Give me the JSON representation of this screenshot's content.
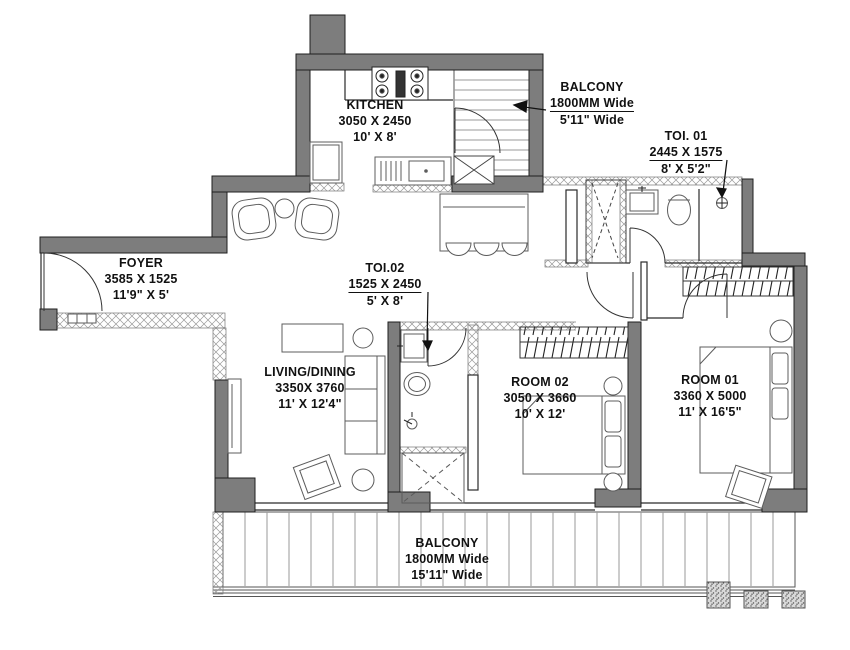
{
  "plan": {
    "title": "2BHK apartment floor plan",
    "colors": {
      "wall": "#7d7d7d",
      "line": "#1f1f1f"
    },
    "rooms": [
      {
        "key": "kitchen",
        "name": "KITCHEN",
        "mm": "3050 X 2450",
        "ft": "10' X 8'"
      },
      {
        "key": "balcony-top",
        "name": "BALCONY",
        "mm": "1800MM Wide",
        "ft": "5'11\" Wide"
      },
      {
        "key": "toi-01",
        "name": "TOI. 01",
        "mm": "2445 X 1575",
        "ft": "8' X 5'2\""
      },
      {
        "key": "foyer",
        "name": "FOYER",
        "mm": "3585 X 1525",
        "ft": "11'9\" X 5'"
      },
      {
        "key": "toi-02",
        "name": "TOI.02",
        "mm": "1525 X 2450",
        "ft": "5' X 8'"
      },
      {
        "key": "living-dining",
        "name": "LIVING/DINING",
        "mm": "3350X 3760",
        "ft": "11' X 12'4\""
      },
      {
        "key": "room-02",
        "name": "ROOM 02",
        "mm": "3050 X 3660",
        "ft": "10' X 12'"
      },
      {
        "key": "room-01",
        "name": "ROOM 01",
        "mm": "3360 X 5000",
        "ft": "11' X 16'5\""
      },
      {
        "key": "balcony-bottom",
        "name": "BALCONY",
        "mm": "1800MM Wide",
        "ft": "15'11\" Wide"
      }
    ]
  }
}
